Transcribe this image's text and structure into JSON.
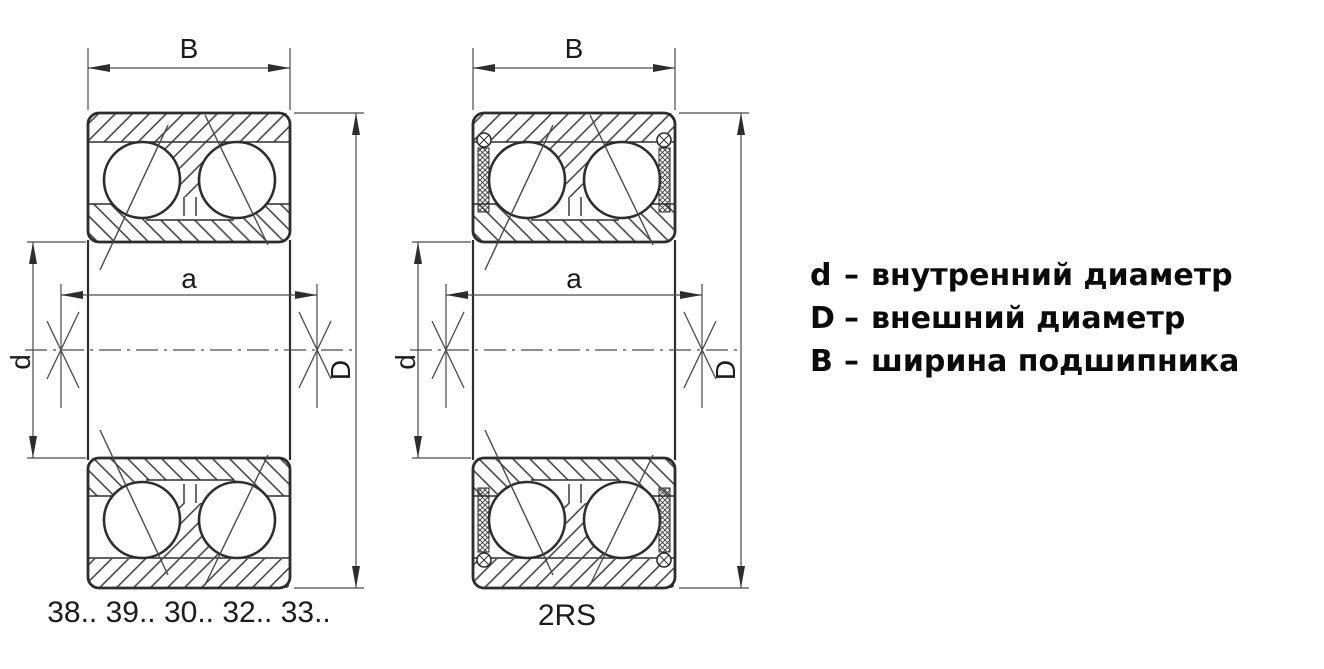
{
  "drawing": {
    "dimension_labels": {
      "width": "B",
      "span": "a",
      "bore": "d",
      "outer": "D"
    },
    "left_bearing": {
      "caption": "38.. 39.. 30.. 32.. 33.."
    },
    "right_bearing": {
      "caption": "2RS"
    }
  },
  "legend": {
    "separator": "–",
    "items": [
      {
        "term": "d",
        "description": "внутренний диаметр"
      },
      {
        "term": "D",
        "description": "внешний диаметр"
      },
      {
        "term": "B",
        "description": "ширина подшипника"
      }
    ]
  },
  "colors": {
    "line": "#2d2d2d",
    "thin_line": "#4a4a4a",
    "text": "#1c1c1c",
    "background": "#ffffff"
  }
}
